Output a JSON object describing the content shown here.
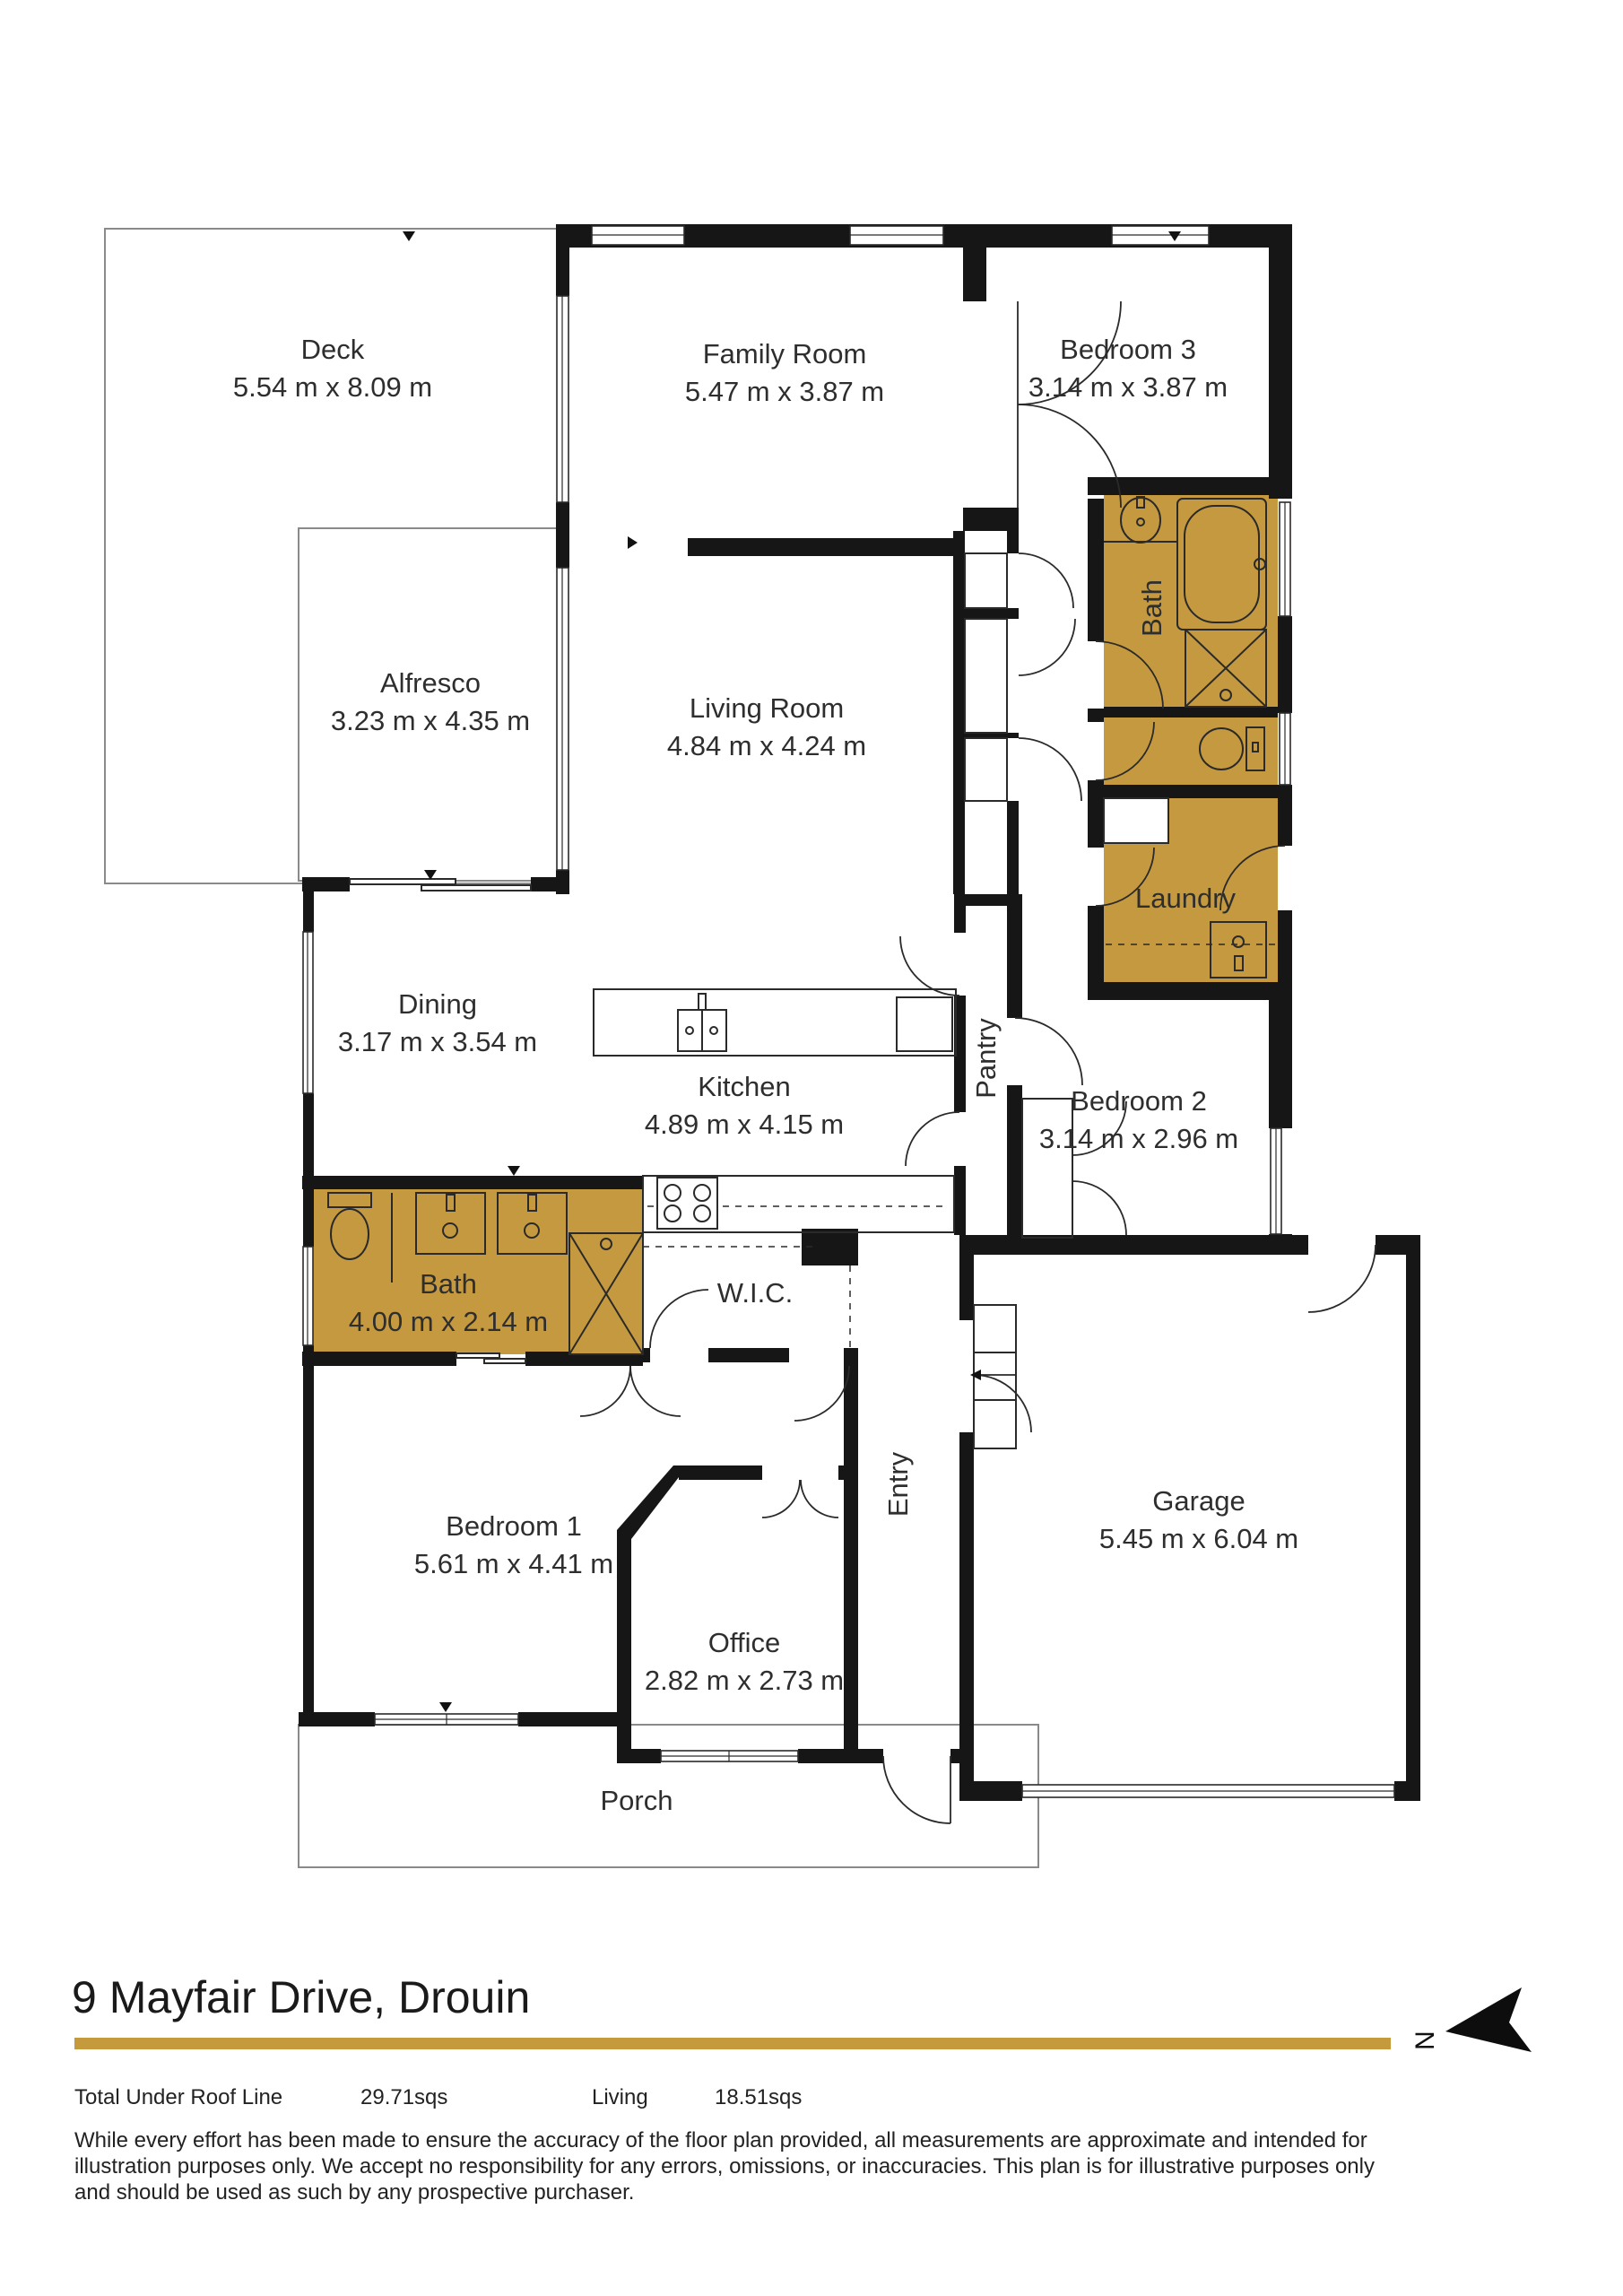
{
  "meta": {
    "address": "9 Mayfair Drive, Drouin",
    "north_label": "N"
  },
  "summary": {
    "total_label": "Total Under Roof Line",
    "total_value": "29.71sqs",
    "living_label": "Living",
    "living_value": "18.51sqs"
  },
  "disclaimer": "While every effort has been made to ensure the accuracy of the floor plan provided, all measurements are approximate and intended for illustration purposes only. We accept no responsibility for any errors, omissions, or inaccuracies. This plan is for illustrative purposes only and should be used as such by any prospective purchaser.",
  "colors": {
    "wet_area": "#c5993f",
    "accent_rule": "#c49a3c",
    "wall": "#161616"
  },
  "rooms": {
    "deck": {
      "name": "Deck",
      "dims": "5.54 m x 8.09 m"
    },
    "family": {
      "name": "Family Room",
      "dims": "5.47 m x 3.87 m"
    },
    "bedroom3": {
      "name": "Bedroom 3",
      "dims": "3.14 m x 3.87 m"
    },
    "alfresco": {
      "name": "Alfresco",
      "dims": "3.23 m x 4.35 m"
    },
    "living": {
      "name": "Living Room",
      "dims": "4.84 m x 4.24 m"
    },
    "bath_ensuite": {
      "name": "Bath"
    },
    "laundry": {
      "name": "Laundry"
    },
    "dining": {
      "name": "Dining",
      "dims": "3.17 m x 3.54 m"
    },
    "kitchen": {
      "name": "Kitchen",
      "dims": "4.89 m x 4.15 m"
    },
    "pantry": {
      "name": "Pantry"
    },
    "bedroom2": {
      "name": "Bedroom 2",
      "dims": "3.14 m x 2.96 m"
    },
    "bath_main": {
      "name": "Bath",
      "dims": "4.00 m x 2.14 m"
    },
    "wic": {
      "name": "W.I.C."
    },
    "entry": {
      "name": "Entry"
    },
    "bedroom1": {
      "name": "Bedroom 1",
      "dims": "5.61 m x 4.41 m"
    },
    "office": {
      "name": "Office",
      "dims": "2.82 m x 2.73 m"
    },
    "garage": {
      "name": "Garage",
      "dims": "5.45 m x 6.04 m"
    },
    "porch": {
      "name": "Porch"
    }
  }
}
